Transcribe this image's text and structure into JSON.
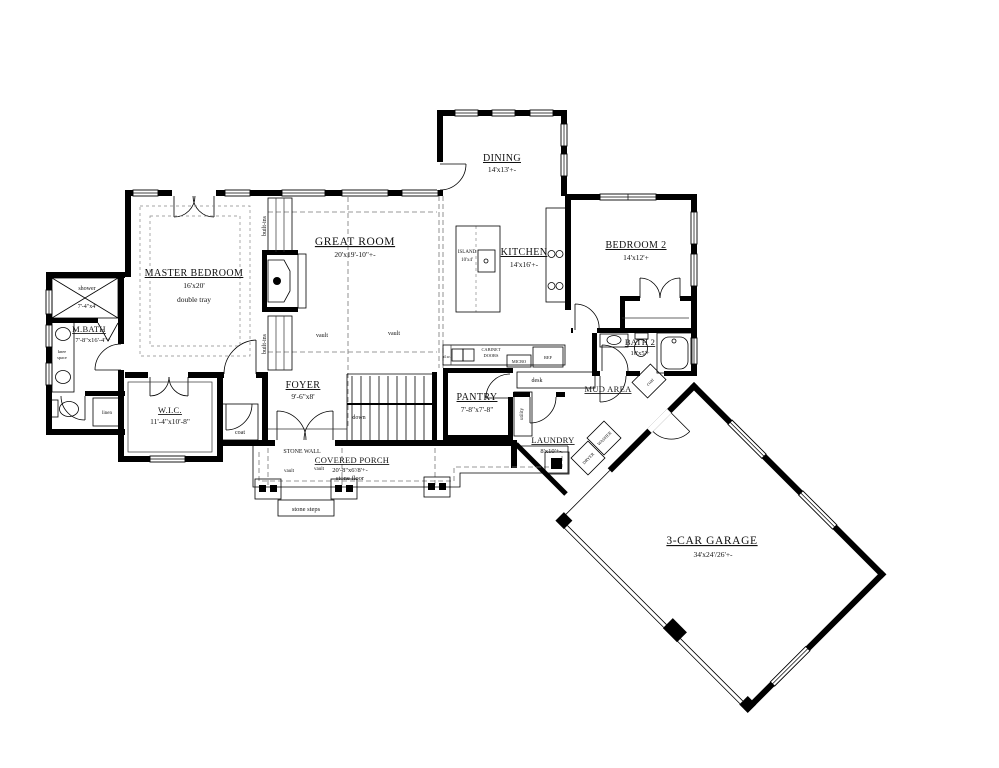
{
  "drawing": {
    "type": "residential floor plan",
    "background_color": "#ffffff",
    "line_color": "#000000"
  },
  "rooms": {
    "master_bedroom": {
      "title": "MASTER BEDROOM",
      "dims": "16'x20'",
      "note": "double tray"
    },
    "m_bath": {
      "title": "M.BATH",
      "dims": "7'-8\"x16'-4\"+"
    },
    "shower": {
      "title": "shower",
      "dims": "7'-4\"x4'"
    },
    "wic": {
      "title": "W.I.C.",
      "dims": "11'-4\"x10'-8\""
    },
    "great_room": {
      "title": "GREAT ROOM",
      "dims": "20'x19'-10\"+-"
    },
    "foyer": {
      "title": "FOYER",
      "dims": "9'-6\"x8'"
    },
    "dining": {
      "title": "DINING",
      "dims": "14'x13'+-"
    },
    "kitchen": {
      "title": "KITCHEN",
      "dims": "14'x16'+-"
    },
    "island": {
      "title": "ISLAND",
      "dims": "10'x4'"
    },
    "bedroom_2": {
      "title": "BEDROOM 2",
      "dims": "14'x12'+"
    },
    "bath_2": {
      "title": "BATH 2",
      "dims": "10'x5'+"
    },
    "mud_area": {
      "title": "MUD AREA"
    },
    "pantry": {
      "title": "PANTRY",
      "dims": "7'-8\"x7'-8\""
    },
    "laundry": {
      "title": "LAUNDRY",
      "dims": "8'x10'+-"
    },
    "covered_porch": {
      "title": "COVERED PORCH",
      "dims": "20'-8\"x6'/8'+-",
      "note": "stone floor"
    },
    "garage": {
      "title": "3-CAR GARAGE",
      "dims": "34'x24'/26'+-"
    }
  },
  "annotations": {
    "built_ins": "built-ins",
    "vault": "vault",
    "down": "down",
    "desk": "desk",
    "utility": "utility",
    "coat": "coat",
    "linen": "linen",
    "knee_1": "knee",
    "knee_2": "space",
    "washer": "WASHER",
    "dryer": "DRYER",
    "micro": "MICRO",
    "ref": "REF",
    "cabinet_1": "CABINET",
    "cabinet_2": "DOORS",
    "dw": "d.w.",
    "stone_wall": "STONE WALL",
    "stone_steps": "stone steps"
  }
}
